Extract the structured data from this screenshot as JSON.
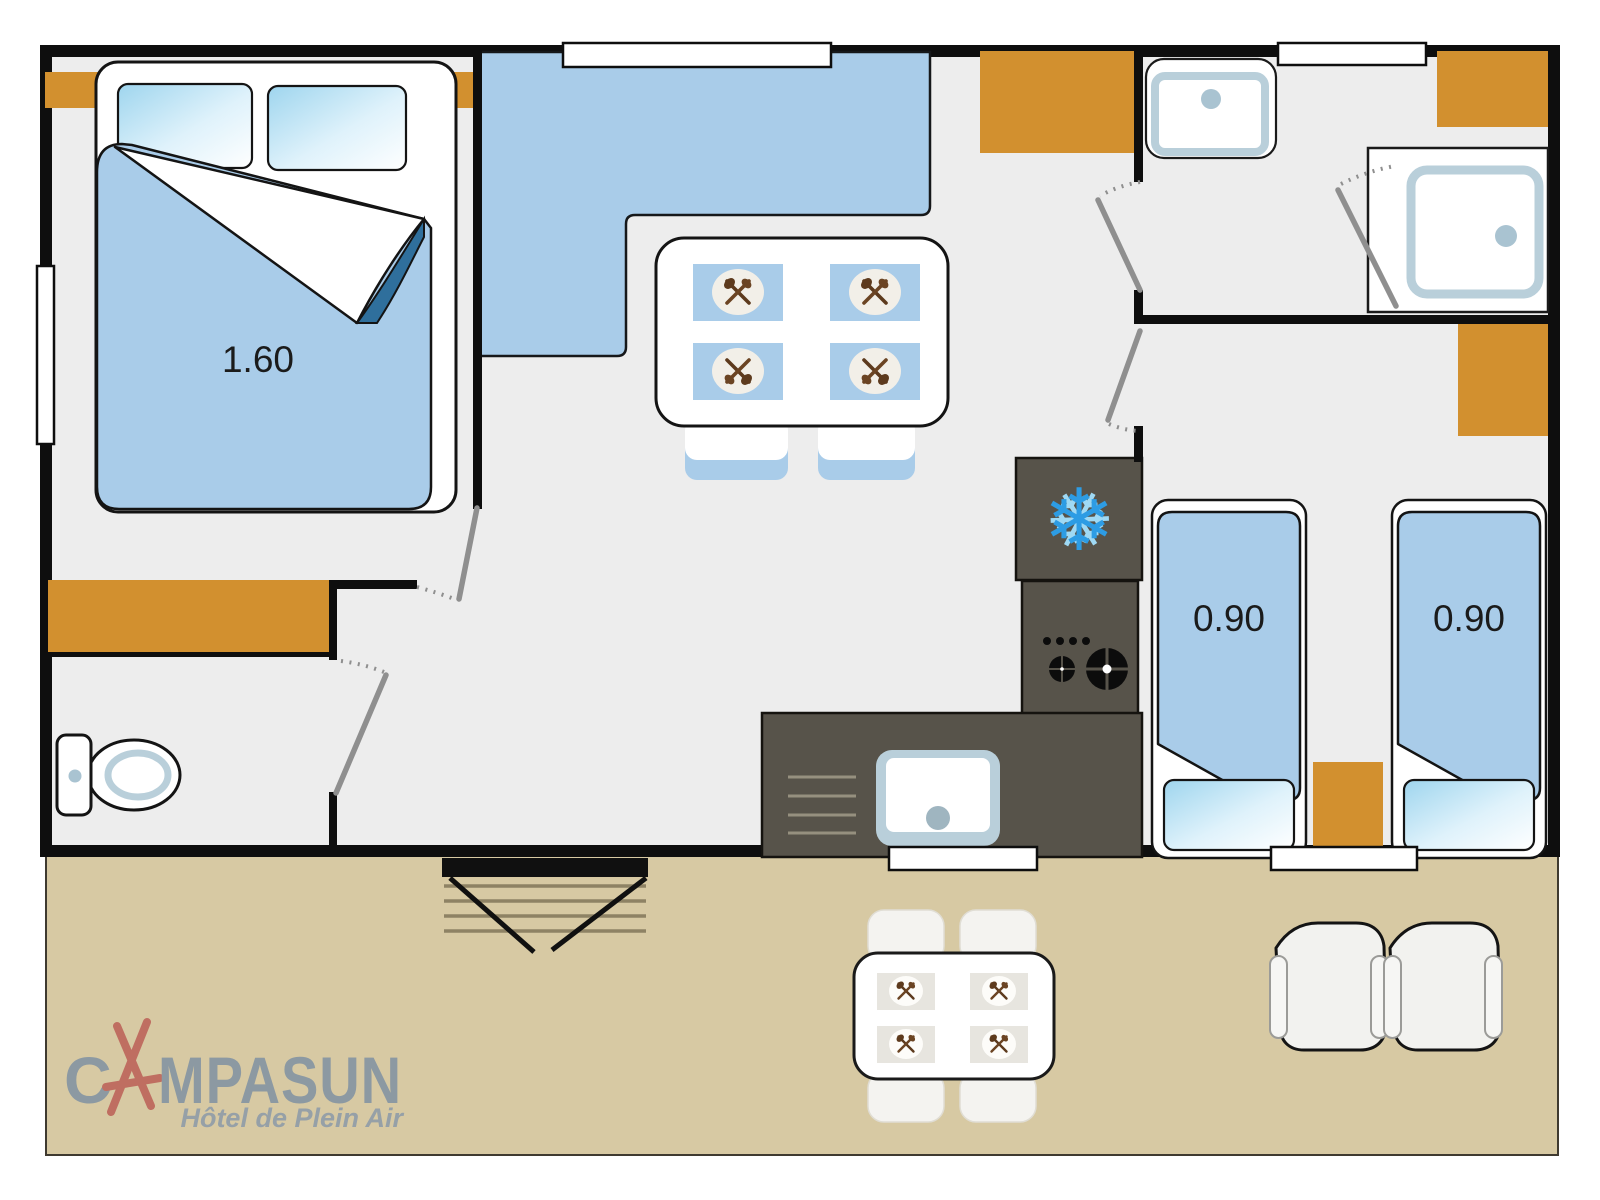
{
  "logo": {
    "part1": "C",
    "part2": "MPASUN",
    "full_wordmark": "CAMPASUN",
    "tagline": "Hôtel de Plein Air"
  },
  "dimensions": {
    "double_bed": "1.60",
    "twin_bed_left": "0.90",
    "twin_bed_right": "0.90"
  },
  "icons": {
    "fridge": "snowflake-icon",
    "place_setting": "crossed-fork-spoon-icon",
    "fridge_glyph": "❄"
  },
  "colors": {
    "floor_gray": "#ededed",
    "wall_black": "#0e0e0e",
    "terrace_beige": "#d7c9a3",
    "furniture_blue": "#a9cce9",
    "accent_orange": "#d2902f",
    "kitchen_dark": "#57534a",
    "snowflake_blue": "#2d9ce4",
    "fixture_trim_blue": "#b9cfda",
    "sheet_fold_blue": "#2f6f9c",
    "logo_gray": "#8c99a2",
    "logo_red": "#bf6e61"
  }
}
